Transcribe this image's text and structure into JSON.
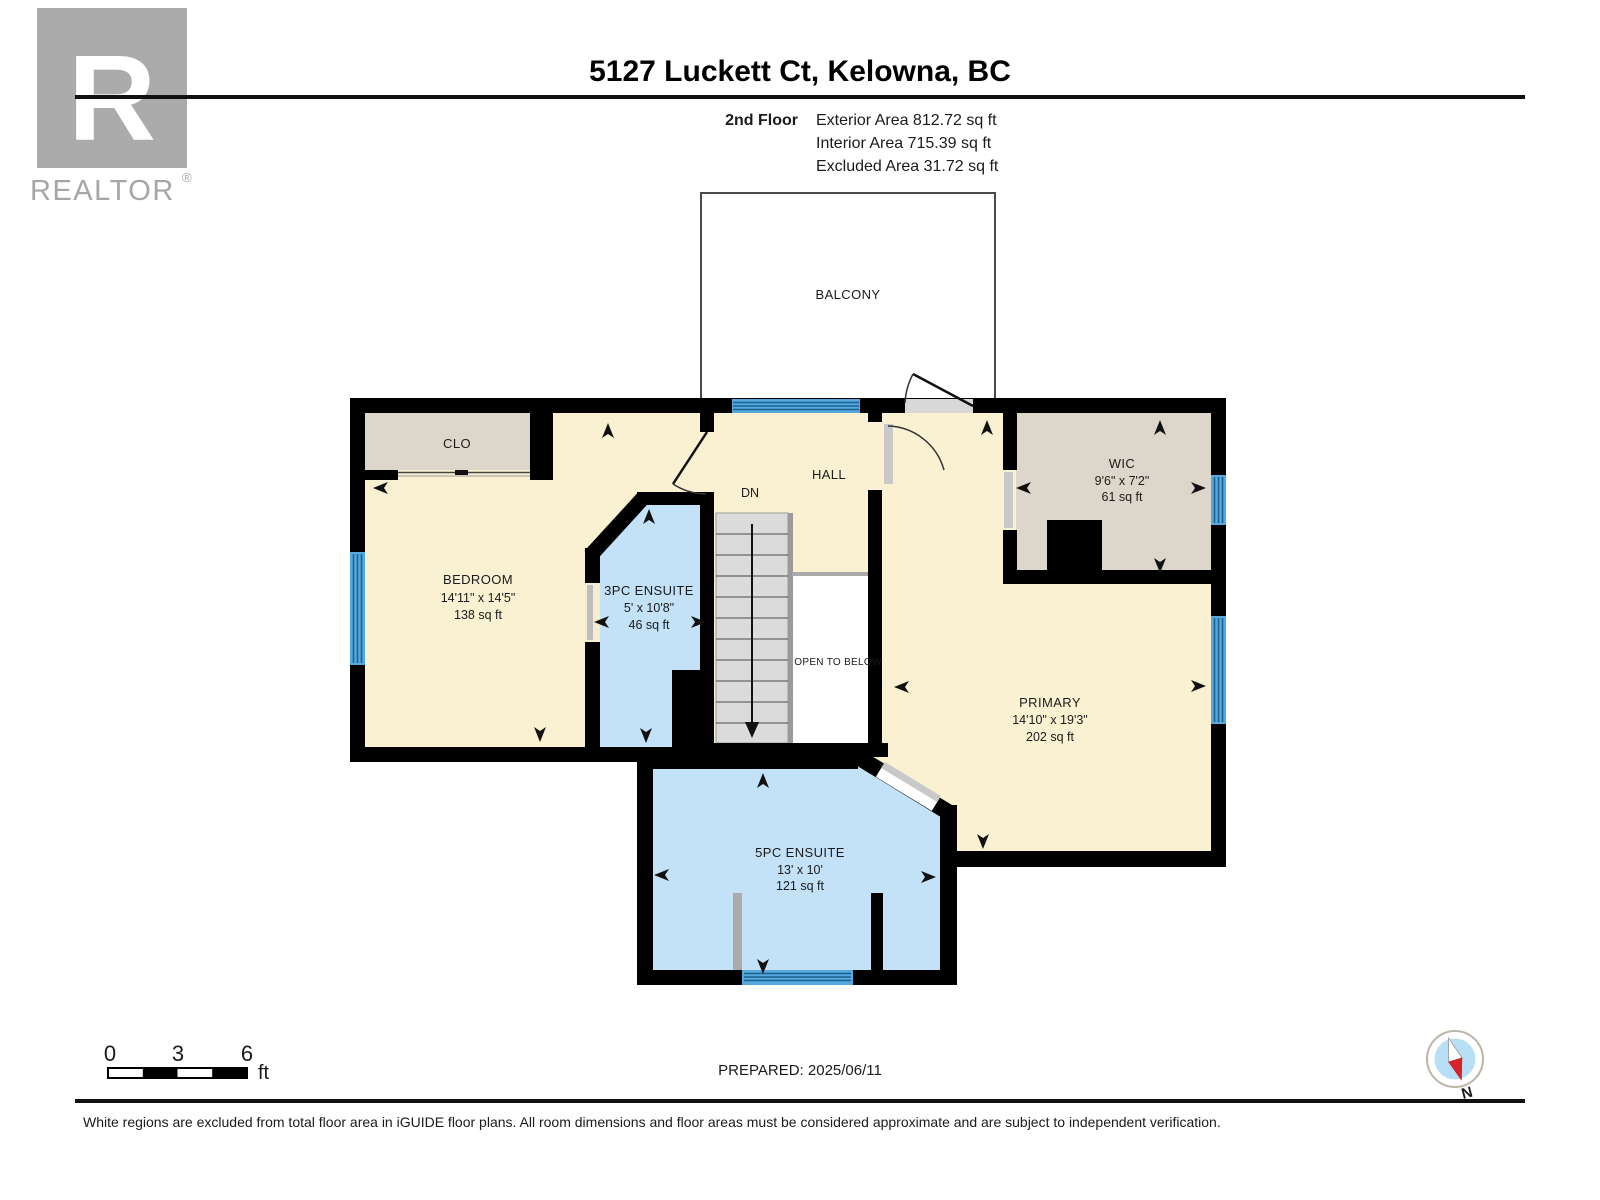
{
  "header": {
    "title": "5127 Luckett Ct, Kelowna, BC",
    "floor_label": "2nd Floor",
    "areas": [
      "Exterior Area 812.72 sq ft",
      "Interior Area 715.39 sq ft",
      "Excluded Area 31.72 sq ft"
    ]
  },
  "logo": {
    "letter": "R",
    "name": "REALTOR",
    "reg": "®"
  },
  "plan": {
    "rooms": {
      "balcony": {
        "name": "BALCONY"
      },
      "clo": {
        "name": "CLO"
      },
      "bedroom": {
        "name": "BEDROOM",
        "dims": "14'11\" x 14'5\"",
        "area": "138 sq ft"
      },
      "ensuite3": {
        "name": "3PC ENSUITE",
        "dims": "5' x 10'8\"",
        "area": "46 sq ft"
      },
      "hall": {
        "name": "HALL"
      },
      "stairs": {
        "label": "DN"
      },
      "open_to_below": {
        "name": "OPEN TO BELOW"
      },
      "wic": {
        "name": "WIC",
        "dims": "9'6\" x 7'2\"",
        "area": "61 sq ft"
      },
      "primary": {
        "name": "PRIMARY",
        "dims": "14'10\" x 19'3\"",
        "area": "202 sq ft"
      },
      "ensuite5": {
        "name": "5PC ENSUITE",
        "dims": "13' x 10'",
        "area": "121 sq ft"
      }
    }
  },
  "footer": {
    "scale": {
      "t0": "0",
      "t3": "3",
      "t6": "6",
      "unit": "ft"
    },
    "prepared": "PREPARED: 2025/06/11",
    "compass_n": "N",
    "disclaimer": "White regions are excluded from total floor area in iGUIDE floor plans. All room dimensions and floor areas must be considered approximate and are subject to independent verification."
  },
  "colors": {
    "wall": "#000000",
    "room_cream": "#FAF0D2",
    "room_blue": "#C3E1F7",
    "closet_beige": "#DCD7CA",
    "window_blue": "#55A9DE",
    "window_stripe": "#1D618F",
    "stair_gray": "#DBDBDB",
    "door_gray": "#C9C9C9",
    "logo_gray": "#ABABAB",
    "compass_blue": "#B9DFF6",
    "compass_red": "#D8232A"
  }
}
